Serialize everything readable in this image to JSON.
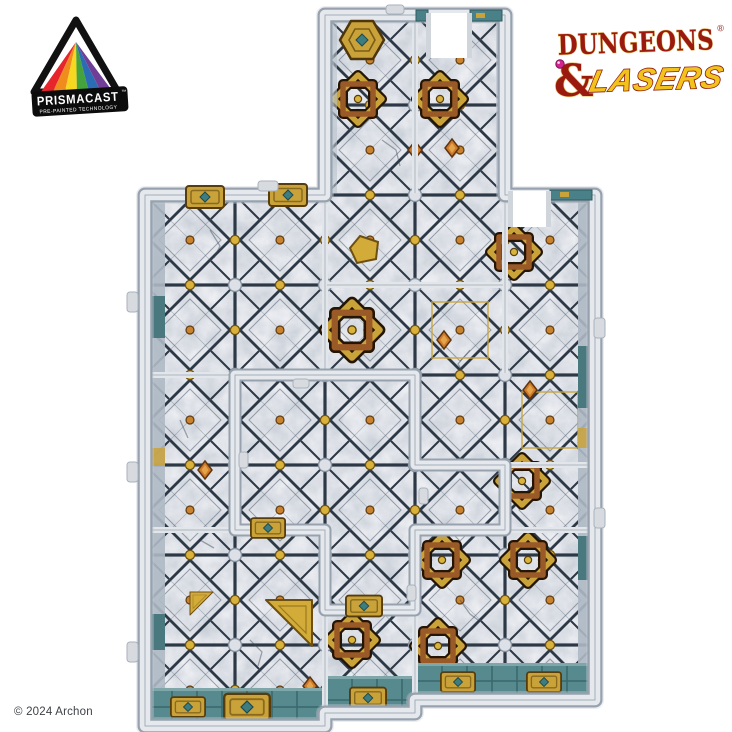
{
  "window": {
    "background": "#ffffff"
  },
  "header": {
    "prismacast_badge": {
      "name": "PRISMACAST",
      "trademark": "™",
      "tagline": "PRE-PAINTED TECHNOLOGY",
      "banner_background": "#0c0c0c",
      "text_color": "#ffffff",
      "rainbow": [
        "#e6252c",
        "#f08c1e",
        "#f7d71f",
        "#45a33d",
        "#2a6db5",
        "#713e97"
      ]
    },
    "brand_logo": {
      "title_word": "DUNGEONS",
      "registered_mark": "®",
      "ampersand": "&",
      "subtitle_word": "LASERS",
      "title_color": "#9b1a0f",
      "title_outline": "#e6c26a",
      "subtitle_color": "#f2c31d",
      "jewel_color": "#d4258f"
    }
  },
  "product_photo": {
    "subject": "Modular dungeon floor sections clipped together into an irregular dungeon layout with a central opening, photographed from above",
    "style": "pre-painted grey stone tiles, dark grout diamond pattern, gold studs, copper-and-teal celtic knot medallions, verdigris wall trims, white doorway gaps in the outer walls",
    "palette": {
      "stone": "#cfd4dc",
      "stone_shadow": "#6f7b8b",
      "grout": "#2c3845",
      "stud": "#dde1e7",
      "gold": "#d9b23c",
      "copper": "#9a5a28",
      "teal_gem": "#357a7d",
      "wall": "#e5e8ec",
      "wall_trim": "#578a8e"
    },
    "layout_grid": [
      "..XX.",
      "..XX.",
      "XXXXX",
      "XXXXX",
      "X..XX",
      "X...X",
      "XX.XX",
      "XXXXX"
    ],
    "features": {
      "knot_medallions": 9,
      "doorway_openings": 2,
      "gold_inlays": 3
    }
  },
  "footer": {
    "copyright": "© 2024 Archon"
  }
}
